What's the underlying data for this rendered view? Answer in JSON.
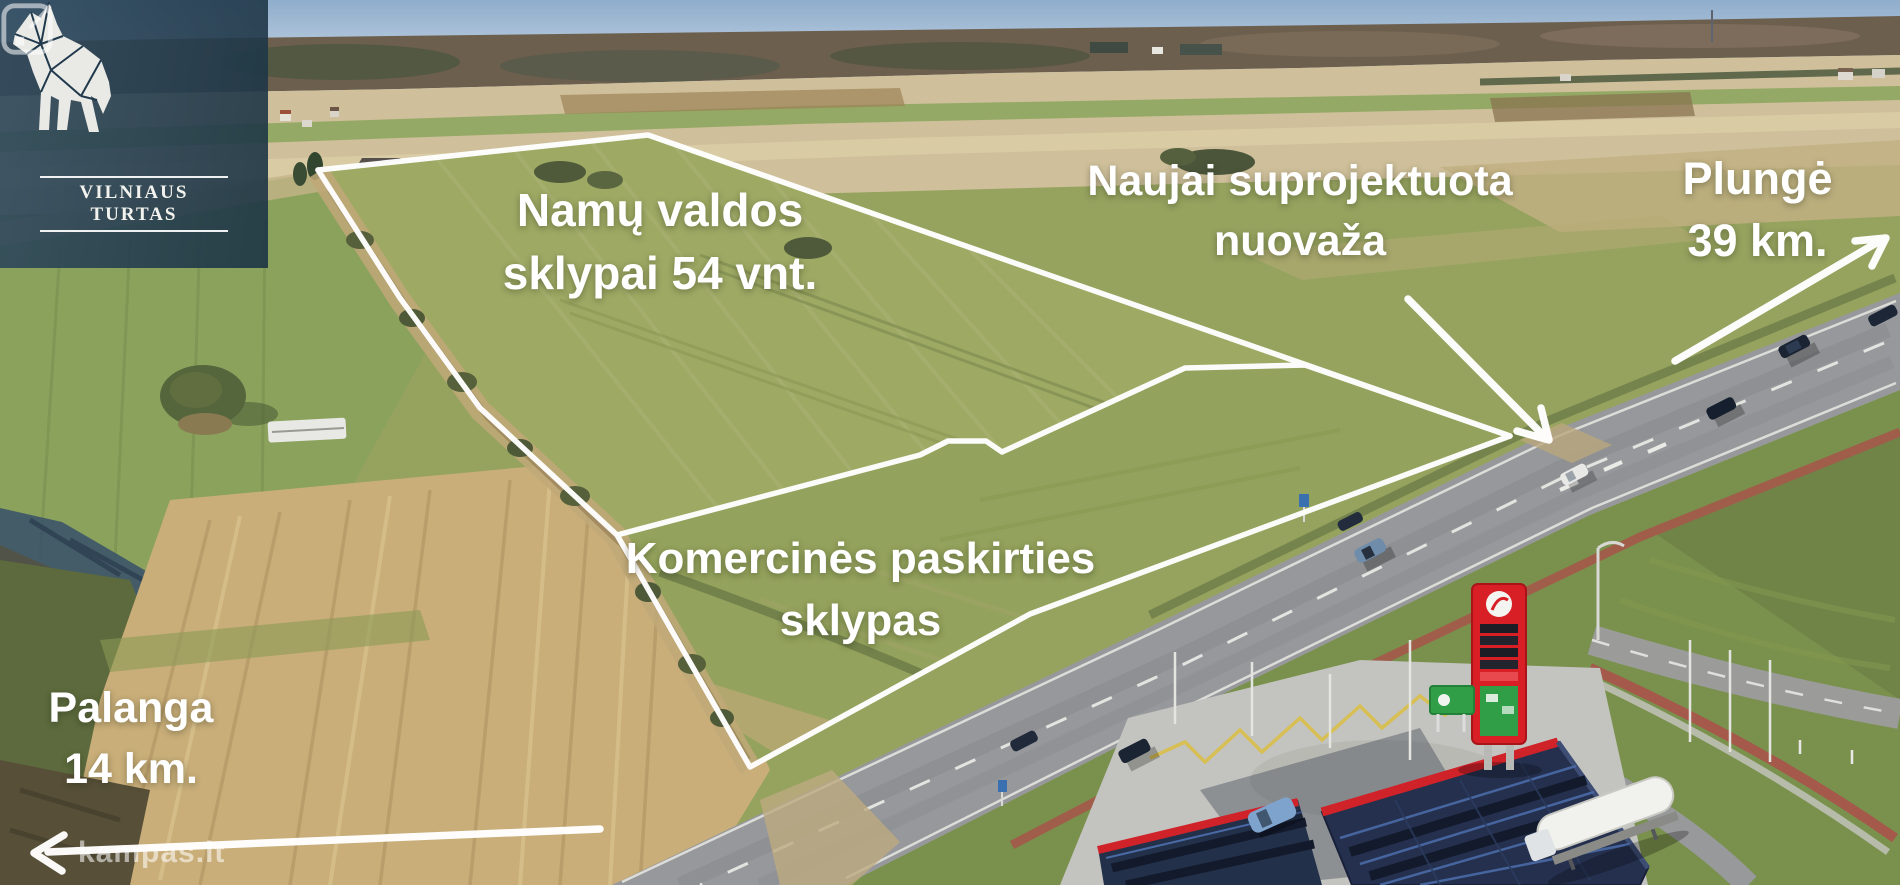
{
  "branding": {
    "agency_logo_text": "VILNIAUS TURTAS",
    "portal_watermark": "kampas.lt"
  },
  "annotations": {
    "residential": {
      "line1": "Namų valdos",
      "line2": "sklypai 54 vnt."
    },
    "access_road": {
      "line1": "Naujai suprojektuota",
      "line2": "nuovaža"
    },
    "plunge_distance": {
      "line1": "Plungė",
      "line2": "39 km."
    },
    "commercial": {
      "line1": "Komercinės paskirties",
      "line2": "sklypas"
    },
    "palanga_distance": {
      "line1": "Palanga",
      "line2": "14 km."
    }
  },
  "colors": {
    "annotation_white": "#ffffff",
    "logo_overlay_bg": "#20394c",
    "station_pylon_red": "#d81f26",
    "station_sign_green": "#2f9e47",
    "canopy_navy": "#24304e",
    "bike_path_red": "#a4594a",
    "sky_blue": "#9db6d1",
    "field_green": "#96a35f",
    "dry_field_tan": "#c9ae79",
    "highway_gray": "#97989b"
  }
}
